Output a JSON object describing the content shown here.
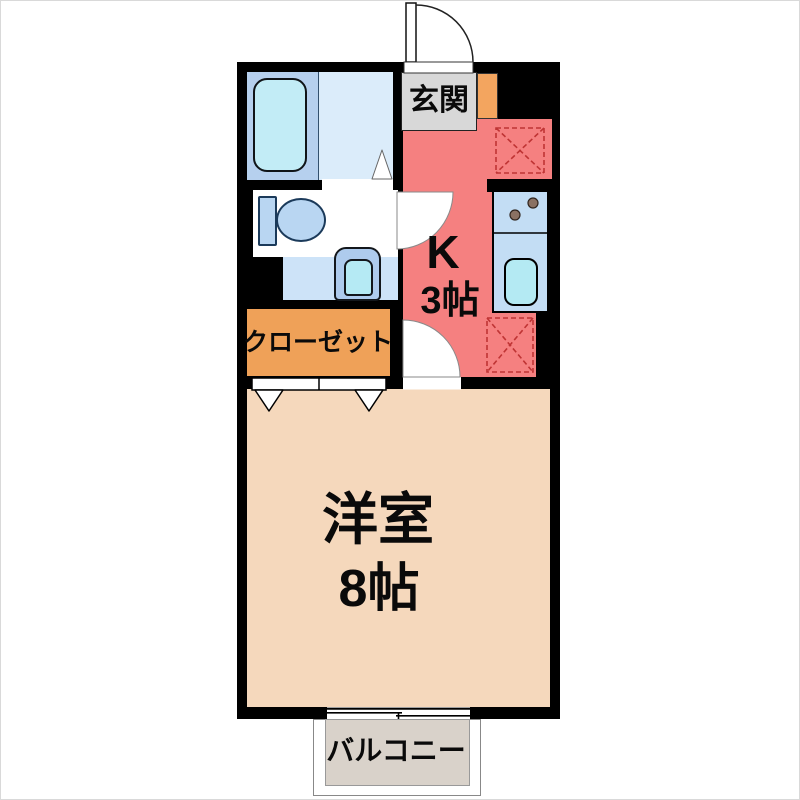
{
  "plan": {
    "entrance": {
      "label": "玄関"
    },
    "kitchen": {
      "label": "K",
      "size": "3帖"
    },
    "closet": {
      "label": "クローゼット"
    },
    "room": {
      "label": "洋室",
      "size": "8帖"
    },
    "balcony": {
      "label": "バルコニー"
    }
  },
  "colors": {
    "wall": "#000000",
    "kitchen_floor": "#f58080",
    "room_floor": "#f5d8bc",
    "closet": "#efa158",
    "shoe_cabinet": "#f3a55f",
    "genkan": "#d8d8d8",
    "balcony": "#d9d2ca",
    "bath_surround": "#b6d0ee",
    "bath_floor": "#dbecfa",
    "bathtub": "#c2ecf6",
    "toilet_fixture": "#b9d6f2",
    "laundry_area": "#cde3f8",
    "counter": "#c3ddf4",
    "sink": "#b4eaf3",
    "burner": "#8a7163",
    "placement_dash": "#bf3434"
  }
}
